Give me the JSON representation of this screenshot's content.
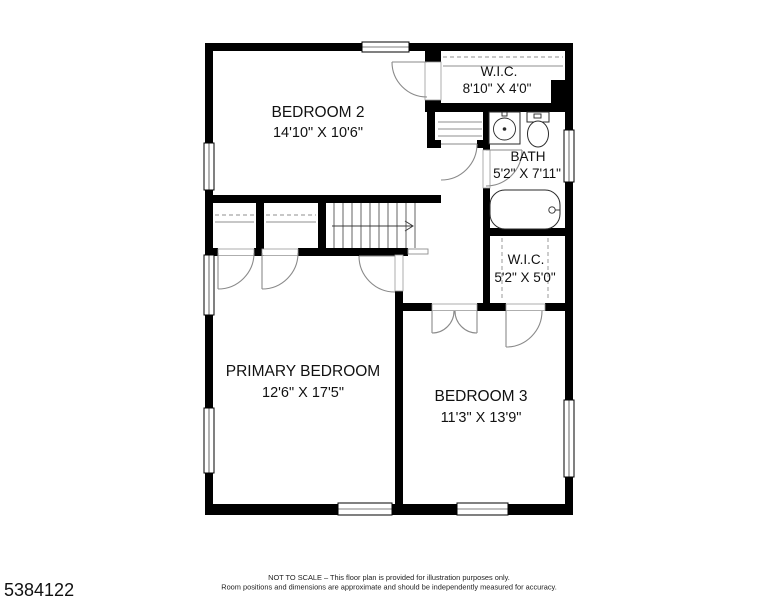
{
  "rooms": {
    "bedroom2": {
      "name": "BEDROOM 2",
      "dims": "14'10\" X 10'6\""
    },
    "wic1": {
      "name": "W.I.C.",
      "dims": "8'10\" X 4'0\""
    },
    "bath": {
      "name": "BATH",
      "dims": "5'2\" X 7'11\""
    },
    "wic2": {
      "name": "W.I.C.",
      "dims": "5'2\" X 5'0\""
    },
    "primary": {
      "name": "PRIMARY BEDROOM",
      "dims": "12'6\" X 17'5\""
    },
    "bedroom3": {
      "name": "BEDROOM 3",
      "dims": "11'3\" X 13'9\""
    }
  },
  "footer": {
    "listing_id": "5384122",
    "disclaimer_line1": "NOT TO SCALE – This floor plan is provided for illustration purposes only.",
    "disclaimer_line2": "Room positions and dimensions are approximate and should be independently measured for accuracy."
  },
  "colors": {
    "wall": "#000000",
    "background": "#ffffff",
    "door_line": "#8a8a8a"
  }
}
